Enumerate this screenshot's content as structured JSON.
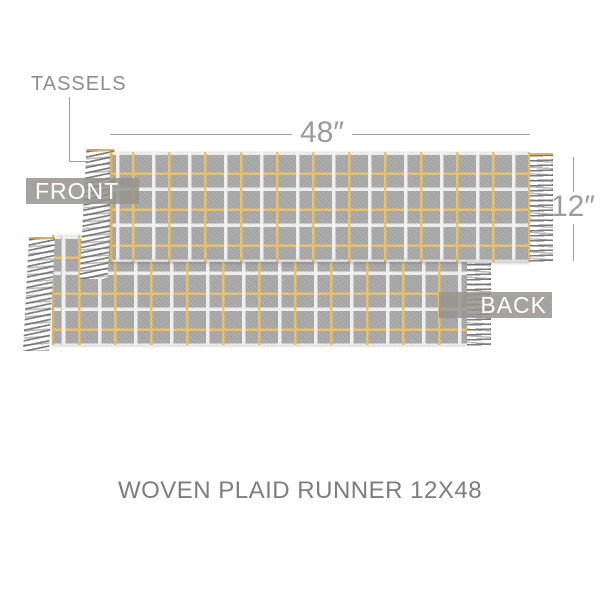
{
  "product": {
    "title": "WOVEN PLAID RUNNER 12X48",
    "labels": {
      "tassels": "TASSELS",
      "front": "FRONT",
      "back": "BACK"
    },
    "dimensions": {
      "width_label": "48″",
      "height_label": "12″"
    },
    "colors": {
      "background": "#ffffff",
      "fabric_gray": "#a7a7a7",
      "plaid_white": "#f4f4f4",
      "plaid_gold": "#e9c168",
      "selvage_gold": "#ddb25c",
      "fringe_gray": "#8f8f8f",
      "annotation_gray": "#9b9b9b",
      "badge_bg": "#a8a5a0",
      "badge_text": "#ffffff",
      "title_gray": "#7d7d7d"
    }
  }
}
